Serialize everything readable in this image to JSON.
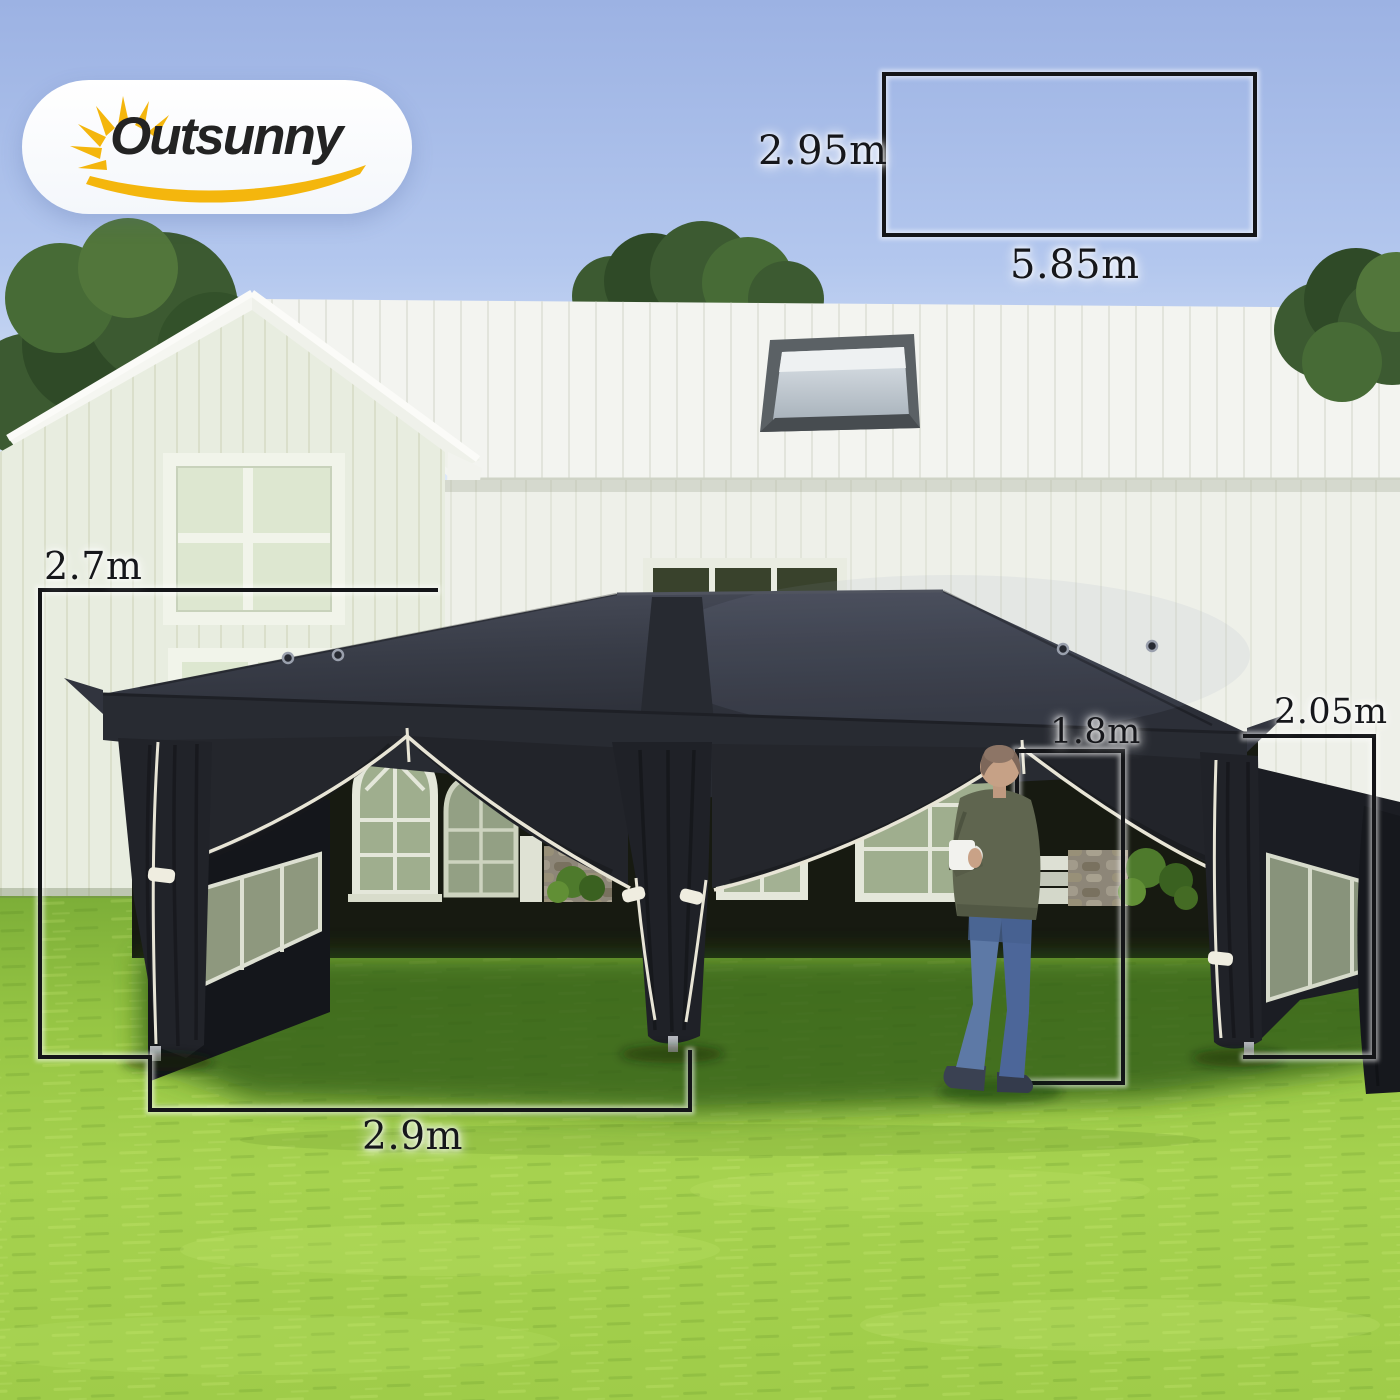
{
  "brand": {
    "name": "Outsunny"
  },
  "folded_size_diagram": {
    "height": "2.95m",
    "width": "5.85m"
  },
  "dimensions": {
    "peak_height": "2.7m",
    "bay_width": "2.9m",
    "door_height": "1.8m",
    "side_height": "2.05m"
  },
  "colors": {
    "sky": "#a9bfec",
    "house_wall": "#eef0e9",
    "house_roof": "#f3f4f0",
    "tent_canopy": "#32353f",
    "tent_curtain": "#23252b",
    "zipper_piping": "#e8e5d6",
    "grass_sunlit": "#a3d04c",
    "grass_shade": "#33591b",
    "logo_accent": "#f4b60d",
    "dimension_line": "#141518"
  }
}
